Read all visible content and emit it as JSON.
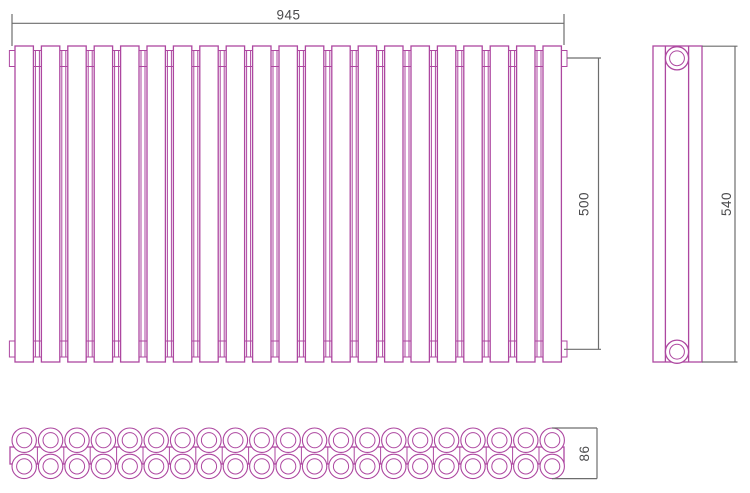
{
  "drawing": {
    "type": "radiator-technical-drawing",
    "views": {
      "front": {
        "label": "front-view",
        "sections": 21
      },
      "side": {
        "label": "side-view",
        "ports": 2
      },
      "bottom": {
        "label": "bottom-view",
        "tubes_per_row": 21,
        "rows": 2
      }
    },
    "dimensions": {
      "width": "945",
      "collector_height": "500",
      "overall_height": "540",
      "depth": "86"
    },
    "colors": {
      "outline": "#ad47a0",
      "dimension_lines": "#6d6d6d",
      "dimension_text": "#4b4b4d",
      "background": "#ffffff"
    }
  }
}
